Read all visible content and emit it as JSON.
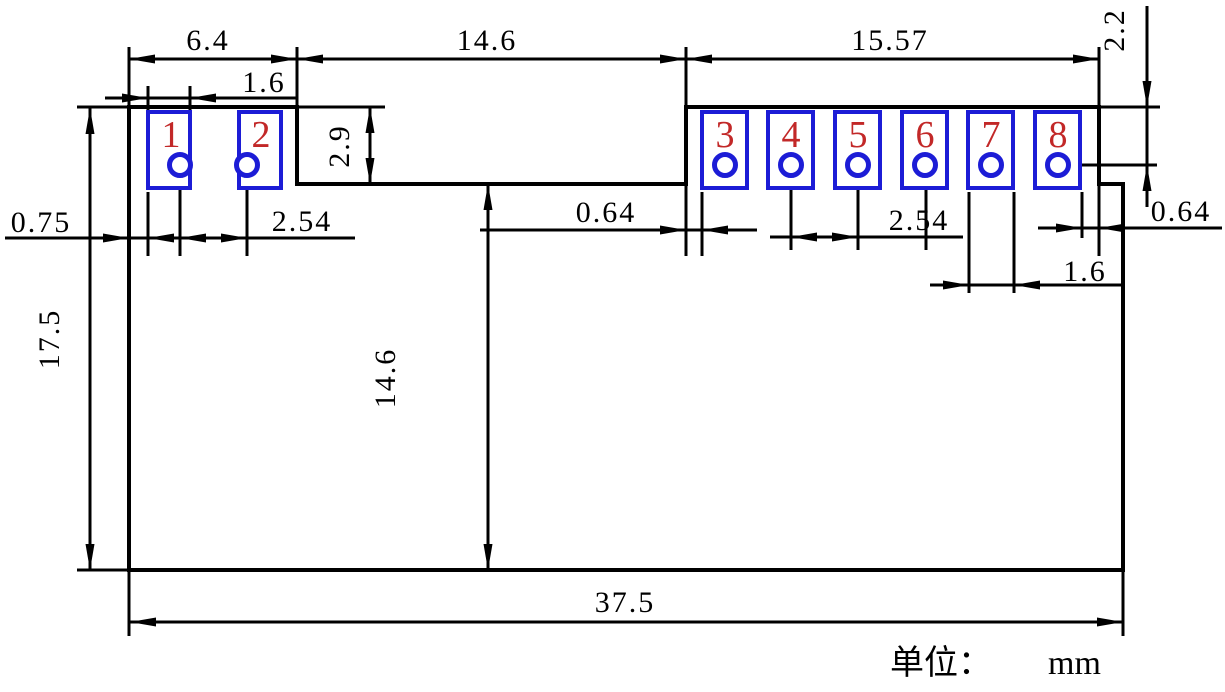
{
  "pads": {
    "numbers": [
      "1",
      "2",
      "3",
      "4",
      "5",
      "6",
      "7",
      "8"
    ]
  },
  "dimensions": {
    "top": [
      "6.4",
      "14.6",
      "15.57"
    ],
    "pad_width_left": "1.6",
    "left_edge_to_pad": "0.75",
    "pitch_left": "2.54",
    "notch_to_pad3": "0.64",
    "pitch_right": "2.54",
    "pad8_to_edge": "0.64",
    "pad_width_right": "1.6",
    "overall_height": "17.5",
    "body_height": "14.6",
    "pad_row_height": "2.9",
    "top_to_hole_center": "2.2",
    "overall_width": "37.5"
  },
  "note": {
    "unit_label": "单位：",
    "unit_value": "mm"
  },
  "colors": {
    "line": "#000000",
    "pad_stroke": "#1c1cd6",
    "pad_number": "#c22828"
  }
}
